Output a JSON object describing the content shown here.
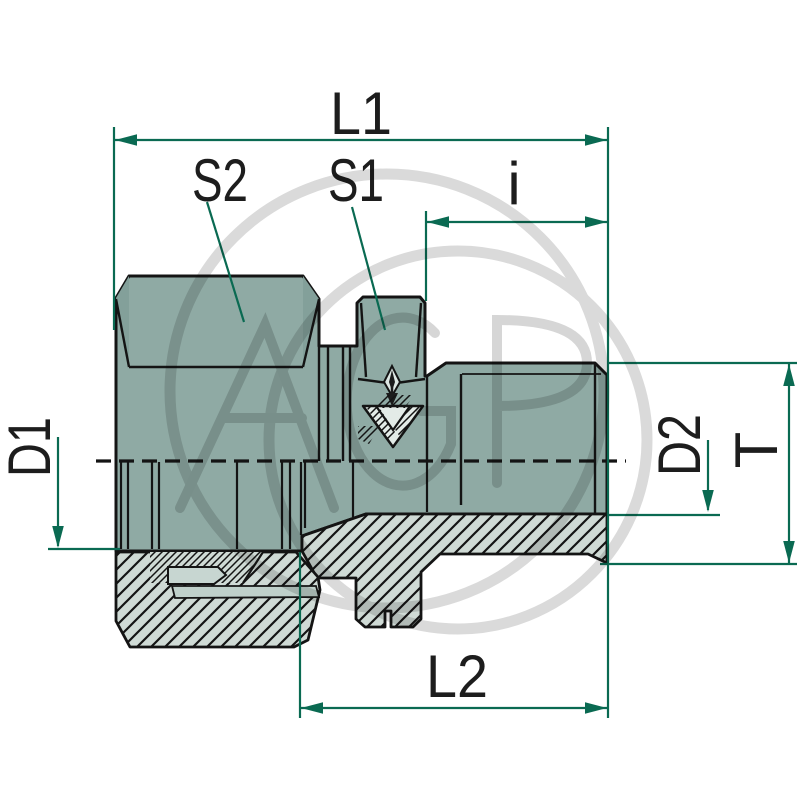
{
  "diagram": {
    "type": "technical-drawing-pipe-fitting",
    "dimension_labels": {
      "l1": "L1",
      "s2": "S2",
      "s1": "S1",
      "i": "i",
      "d1": "D1",
      "d2": "D2",
      "t": "T",
      "l2": "L2"
    },
    "watermark": {
      "text": "AGP"
    },
    "colors": {
      "dimension_line": "#0a6a52",
      "body_fill": "#8faaa4",
      "body_chamfer_fill": "#83a09a",
      "section_fill": "#cfdad5",
      "light_detail_fill": "#e3ebe7",
      "outline": "#141414",
      "watermark_gray": "#d6d6d6",
      "background": "#ffffff"
    }
  }
}
